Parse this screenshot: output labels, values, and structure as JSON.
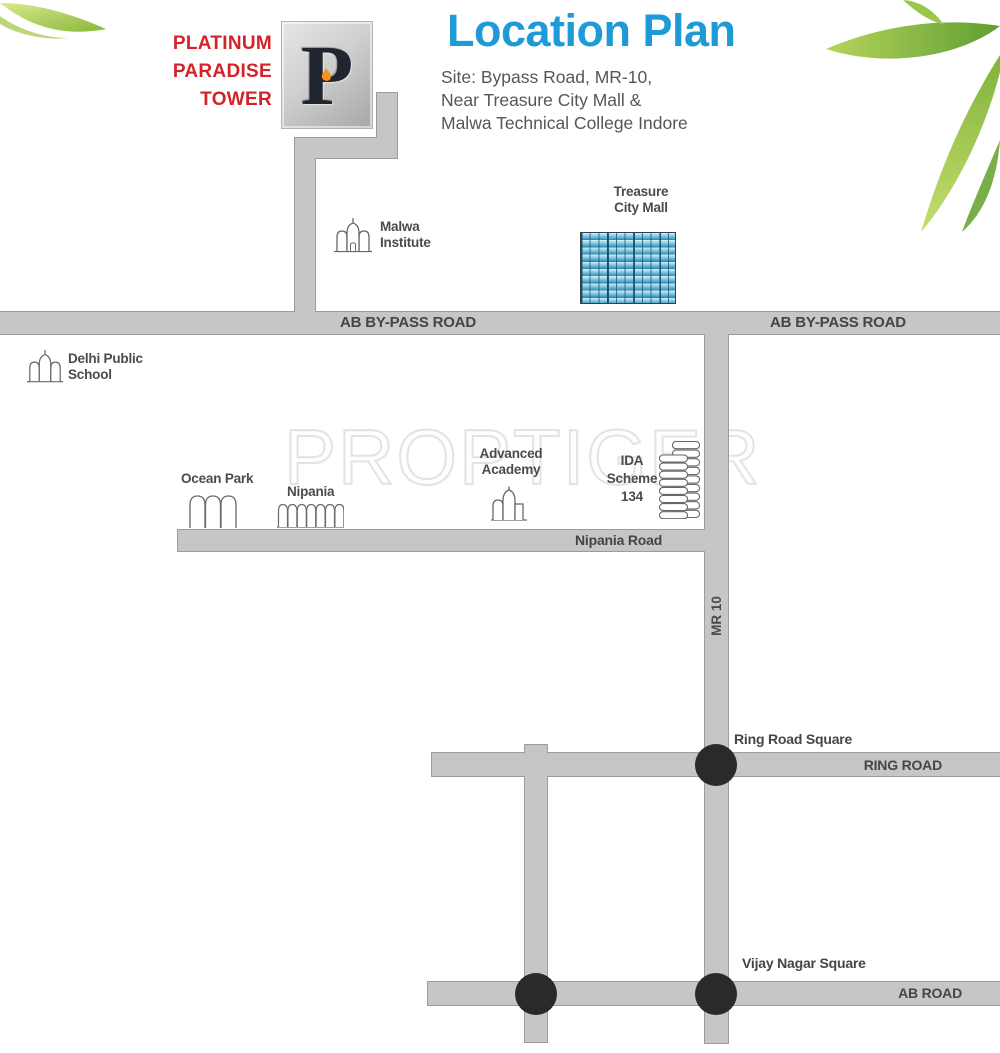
{
  "brand": {
    "name": "PLATINUM\nPARADISE\nTOWER",
    "logo_letter": "P"
  },
  "header": {
    "title": "Location Plan",
    "site_address": "Site: Bypass Road, MR-10,\nNear Treasure City Mall &\nMalwa Technical College Indore"
  },
  "watermark": "PROPTIGER",
  "roads": {
    "ab_bypass_label": "AB BY-PASS ROAD",
    "mr10_label": "MR 10",
    "nipania_road_label": "Nipania Road",
    "ring_road_label": "RING ROAD",
    "ab_road_label": "AB ROAD"
  },
  "squares": {
    "ring_road_square": "Ring Road Square",
    "vijay_nagar_square": "Vijay Nagar Square"
  },
  "landmarks": {
    "malwa_institute": "Malwa\nInstitute",
    "treasure_city_mall": "Treasure\nCity Mall",
    "delhi_public_school": "Delhi Public\nSchool",
    "ocean_park": "Ocean Park",
    "nipania": "Nipania",
    "advanced_academy": "Advanced\nAcademy",
    "ida_scheme": "IDA\nScheme\n134"
  },
  "icons": {
    "malwa_institute": "dome-building-icon",
    "delhi_public_school": "dome-building-icon",
    "ocean_park": "triple-arch-icon",
    "nipania": "fence-arches-icon",
    "advanced_academy": "dome-building-icon",
    "ida_scheme": "stacked-blocks-icon",
    "treasure_city_mall": "window-grid-building",
    "junctions": "black-dot-junction",
    "decoration": "green-leaf"
  },
  "colors": {
    "title_blue": "#1e9bd7",
    "brand_red": "#d5222a",
    "road_fill": "#c6c6c8",
    "road_border": "#9c9c9c",
    "junction_black": "#2b2a29",
    "mall_blue": "#58add0",
    "label_gray": "#4b4b4d",
    "watermark_gray": "#e3e3e3",
    "leaf_green": "#8fbf3a"
  }
}
